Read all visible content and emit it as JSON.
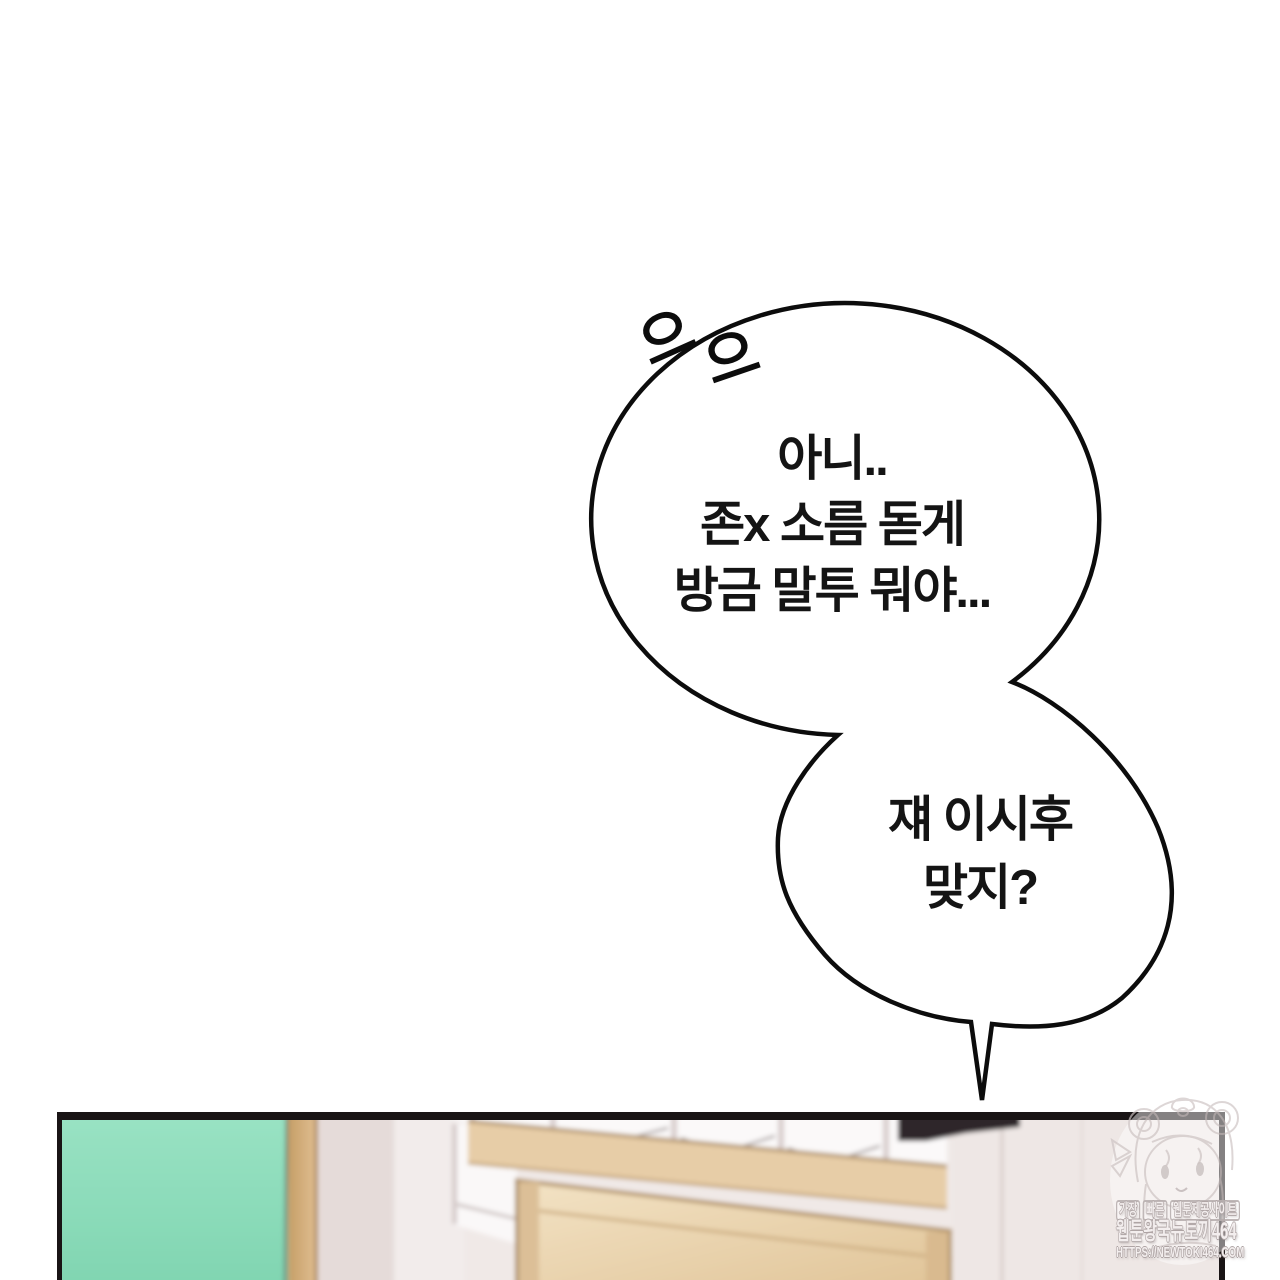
{
  "comic": {
    "sfx_marks": [
      "으",
      "으"
    ],
    "bubbles": [
      {
        "lines": [
          "아니..",
          "존x 소름 돋게",
          "방금 말투 뭐야..."
        ]
      },
      {
        "lines": [
          "쟤 이시후",
          "맞지?"
        ]
      }
    ]
  },
  "watermark": {
    "tagline_words": [
      "가장",
      "빠른",
      "웹툰제공사이트"
    ],
    "site_name": "웹툰왕국뉴토끼464",
    "site_url": "HTTPS://NEWTOKI464.COM",
    "mascot_icon": "anime-girl-bear-hood-mascot"
  },
  "panel": {
    "colors": {
      "board_green": "#8edcba",
      "frame_tan": "#d9b585",
      "beam_tan": "#e7cda7",
      "door_beige": "#ecd6b2",
      "wall_light": "#f0e9e7",
      "wall_mid": "#e5dbd9",
      "wall_pillar": "#f2eceb",
      "glass_white": "#fbf9f9",
      "border_black": "#191415"
    }
  }
}
